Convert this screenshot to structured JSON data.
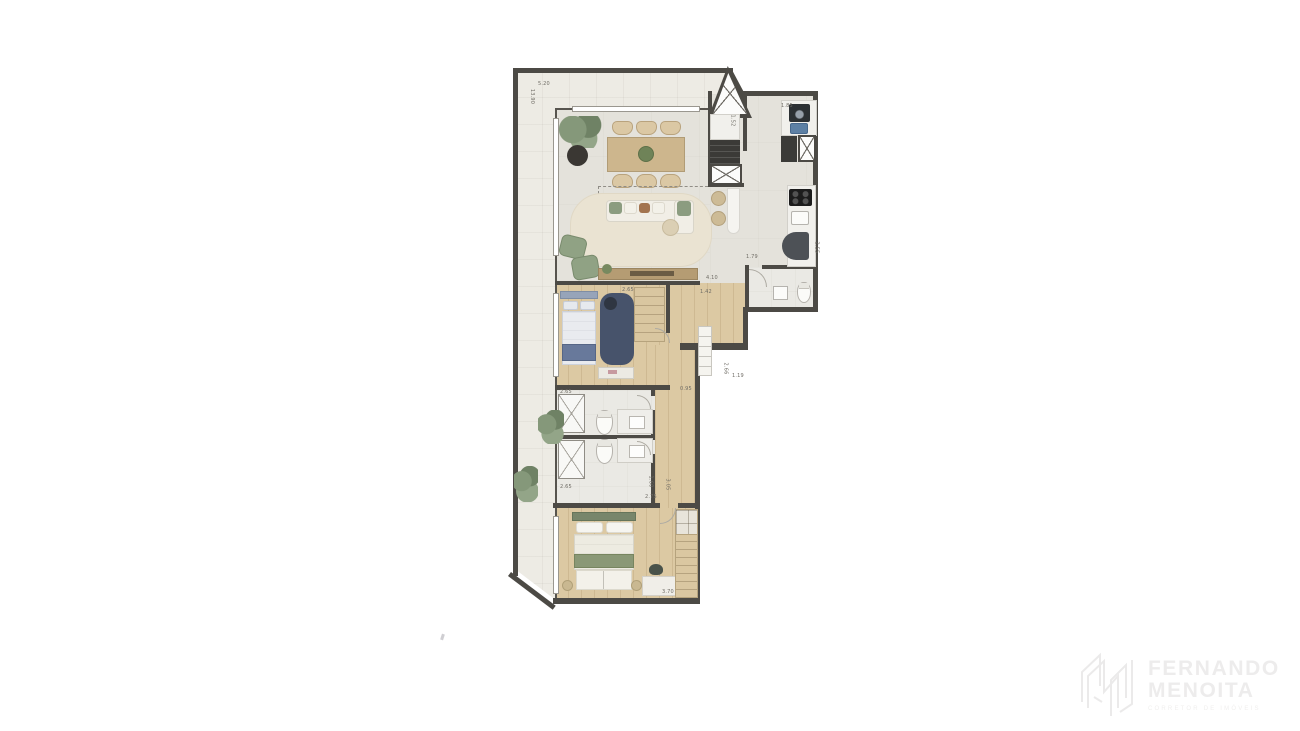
{
  "plan": {
    "dimensions": [
      {
        "id": "terrace-top-width",
        "text": "5.20"
      },
      {
        "id": "terrace-left-height",
        "text": "13.90"
      },
      {
        "id": "laundry-width",
        "text": "1.85"
      },
      {
        "id": "column-depth",
        "text": "1.52"
      },
      {
        "id": "lavabo-width",
        "text": "1.79"
      },
      {
        "id": "lavabo-depth",
        "text": "2.55"
      },
      {
        "id": "hall-length",
        "text": "4.10"
      },
      {
        "id": "bedroom1-width",
        "text": "2.65"
      },
      {
        "id": "closet-width",
        "text": "1.42"
      },
      {
        "id": "hall-right-depth",
        "text": "2.66"
      },
      {
        "id": "hall-step",
        "text": "1.19"
      },
      {
        "id": "corridor-width",
        "text": "0.95"
      },
      {
        "id": "bathroom-width",
        "text": "2.65"
      },
      {
        "id": "balcony-lower-width",
        "text": "2.65"
      },
      {
        "id": "bathroom-depth",
        "text": "1.60"
      },
      {
        "id": "bedroom2-depth",
        "text": "3.05"
      },
      {
        "id": "bedroom2-inner-width",
        "text": "2.75"
      },
      {
        "id": "bedroom2-width",
        "text": "3.70"
      }
    ]
  },
  "watermark": {
    "line1": "FERNANDO",
    "line2": "MENOITA",
    "tagline": "CORRETOR DE IMÓVEIS"
  },
  "colors": {
    "wall": "#4c4a45",
    "wood_floor": "#dcc9a3",
    "tile_floor": "#e4e2db",
    "terrace_floor": "#edebe4",
    "accent_green": "#8a9b7f",
    "accent_navy": "#67799a",
    "watermark_gray": "#edecec"
  }
}
